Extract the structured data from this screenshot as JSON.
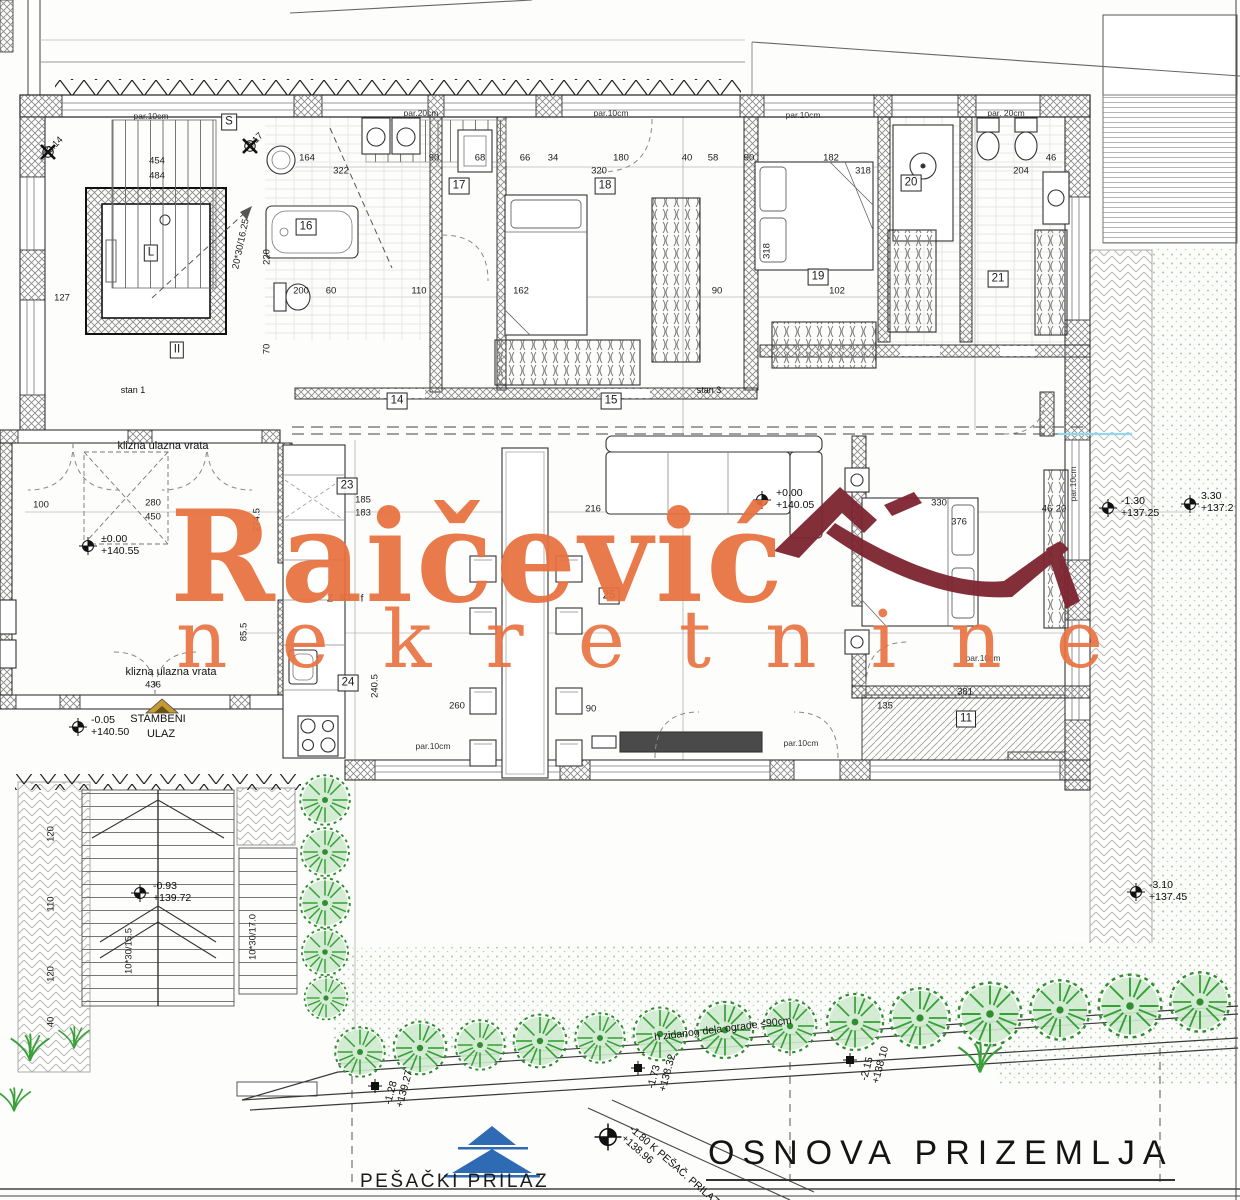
{
  "watermark": {
    "name": "Raičević",
    "subtitle": "nekretnine",
    "accent_color": "#e8713f",
    "roof_color": "#7d2430"
  },
  "title_block": {
    "title": "OSNOVA PRIZEMLJA"
  },
  "site": {
    "pesacki_prilaz": "PEŠAČKI PRILAZ"
  },
  "colors": {
    "tree_green": "#35a035",
    "lawn_dot": "#a3cba3",
    "blue_symbol": "#2f6ab5",
    "gold_symbol": "#c49a33",
    "cyan_line": "#8fd8ea"
  },
  "room_labels": [
    {
      "label": "S",
      "x": 229,
      "y": 122
    },
    {
      "label": "L",
      "x": 151,
      "y": 253
    },
    {
      "label": "II",
      "x": 177,
      "y": 350
    },
    {
      "label": "16",
      "x": 306,
      "y": 227
    },
    {
      "label": "17",
      "x": 459,
      "y": 186
    },
    {
      "label": "18",
      "x": 605,
      "y": 186
    },
    {
      "label": "19",
      "x": 818,
      "y": 277
    },
    {
      "label": "20",
      "x": 911,
      "y": 183
    },
    {
      "label": "21",
      "x": 998,
      "y": 279
    },
    {
      "label": "14",
      "x": 397,
      "y": 401
    },
    {
      "label": "15",
      "x": 611,
      "y": 401
    },
    {
      "label": "23",
      "x": 347,
      "y": 486
    },
    {
      "label": "24",
      "x": 348,
      "y": 683
    },
    {
      "label": "25",
      "x": 609,
      "y": 596
    },
    {
      "label": "11",
      "x": 966,
      "y": 719
    }
  ],
  "dim_labels": [
    {
      "t": "454",
      "x": 157,
      "y": 161
    },
    {
      "t": "484",
      "x": 157,
      "y": 176
    },
    {
      "t": "127",
      "x": 62,
      "y": 298
    },
    {
      "t": "164",
      "x": 307,
      "y": 158
    },
    {
      "t": "90",
      "x": 434,
      "y": 158
    },
    {
      "t": "68",
      "x": 480,
      "y": 158
    },
    {
      "t": "66",
      "x": 525,
      "y": 158
    },
    {
      "t": "34",
      "x": 553,
      "y": 158
    },
    {
      "t": "180",
      "x": 621,
      "y": 158
    },
    {
      "t": "40",
      "x": 687,
      "y": 158
    },
    {
      "t": "58",
      "x": 713,
      "y": 158
    },
    {
      "t": "90",
      "x": 749,
      "y": 158
    },
    {
      "t": "182",
      "x": 831,
      "y": 158
    },
    {
      "t": "46",
      "x": 1051,
      "y": 158
    },
    {
      "t": "322",
      "x": 341,
      "y": 171
    },
    {
      "t": "320",
      "x": 599,
      "y": 171
    },
    {
      "t": "318",
      "x": 863,
      "y": 171
    },
    {
      "t": "204",
      "x": 1021,
      "y": 171
    },
    {
      "t": "200",
      "x": 301,
      "y": 291
    },
    {
      "t": "60",
      "x": 331,
      "y": 291
    },
    {
      "t": "110",
      "x": 419,
      "y": 291
    },
    {
      "t": "162",
      "x": 521,
      "y": 291
    },
    {
      "t": "90",
      "x": 717,
      "y": 291
    },
    {
      "t": "102",
      "x": 837,
      "y": 291
    },
    {
      "t": "100",
      "x": 41,
      "y": 505
    },
    {
      "t": "280",
      "x": 153,
      "y": 503
    },
    {
      "t": "450",
      "x": 153,
      "y": 517
    },
    {
      "t": "185",
      "x": 363,
      "y": 500
    },
    {
      "t": "183",
      "x": 363,
      "y": 513
    },
    {
      "t": "216",
      "x": 593,
      "y": 509
    },
    {
      "t": "330",
      "x": 939,
      "y": 503
    },
    {
      "t": "376",
      "x": 959,
      "y": 522
    },
    {
      "t": "46",
      "x": 1047,
      "y": 509
    },
    {
      "t": "20",
      "x": 1061,
      "y": 509
    },
    {
      "t": "63",
      "x": 345,
      "y": 598
    },
    {
      "t": "436",
      "x": 153,
      "y": 685
    },
    {
      "t": "260",
      "x": 457,
      "y": 706
    },
    {
      "t": "90",
      "x": 591,
      "y": 709
    },
    {
      "t": "381",
      "x": 965,
      "y": 692
    },
    {
      "t": "135",
      "x": 885,
      "y": 706
    },
    {
      "t": "220",
      "x": 267,
      "y": 257,
      "r": -90
    },
    {
      "t": "70",
      "x": 267,
      "y": 349,
      "r": -90
    },
    {
      "t": "274.5",
      "x": 257,
      "y": 520,
      "r": -90
    },
    {
      "t": "85.5",
      "x": 244,
      "y": 632,
      "r": -90
    },
    {
      "t": "240.5",
      "x": 375,
      "y": 686,
      "r": -90
    },
    {
      "t": "318",
      "x": 767,
      "y": 251,
      "r": -90
    },
    {
      "t": "120",
      "x": 51,
      "y": 834,
      "r": -90
    },
    {
      "t": "110",
      "x": 51,
      "y": 904,
      "r": -90
    },
    {
      "t": "120",
      "x": 51,
      "y": 974,
      "r": -90
    },
    {
      "t": "40",
      "x": 51,
      "y": 1022,
      "r": -90
    },
    {
      "t": "10*30/15.5",
      "x": 129,
      "y": 951,
      "r": -90
    },
    {
      "t": "10*30/17.0",
      "x": 253,
      "y": 937,
      "r": -90
    },
    {
      "t": "20*30/16.25",
      "x": 241,
      "y": 244,
      "r": -78
    },
    {
      "t": "-2.14",
      "x": 54,
      "y": 146,
      "r": -45
    },
    {
      "t": "-2.17",
      "x": 254,
      "y": 142,
      "r": -45
    }
  ],
  "wall_notes": [
    {
      "t": "par.10cm",
      "x": 151,
      "y": 116
    },
    {
      "t": "par.20cm",
      "x": 421,
      "y": 113
    },
    {
      "t": "par.10cm",
      "x": 611,
      "y": 113
    },
    {
      "t": "par.10cm",
      "x": 803,
      "y": 115
    },
    {
      "t": "par. 20cm",
      "x": 1006,
      "y": 113
    },
    {
      "t": "par.10cm",
      "x": 433,
      "y": 746
    },
    {
      "t": "par.10cm",
      "x": 801,
      "y": 743
    },
    {
      "t": "par.10cm",
      "x": 1073,
      "y": 484,
      "r": -90
    },
    {
      "t": "par.10cm",
      "x": 983,
      "y": 658
    }
  ],
  "notes": [
    {
      "t": "klizna ulazna vrata",
      "x": 163,
      "y": 446,
      "s": 11
    },
    {
      "t": "klizna ulazna vrata",
      "x": 171,
      "y": 672,
      "s": 11
    },
    {
      "t": "STAMBENI",
      "x": 158,
      "y": 719,
      "s": 11
    },
    {
      "t": "ULAZ",
      "x": 161,
      "y": 734,
      "s": 11
    },
    {
      "t": "stan 1",
      "x": 133,
      "y": 390,
      "s": 9
    },
    {
      "t": "stan 3",
      "x": 709,
      "y": 390,
      "s": 9
    },
    {
      "t": "Z",
      "x": 330,
      "y": 599,
      "s": 10
    },
    {
      "t": "f",
      "x": 362,
      "y": 599,
      "s": 10
    },
    {
      "t": "h zidanog dela ograde ≤90cm",
      "x": 723,
      "y": 1029,
      "s": 10.5,
      "r": -7
    }
  ],
  "level_markers": [
    {
      "l1": "±0.00",
      "l2": "+140.55",
      "x": 101,
      "y": 534
    },
    {
      "l1": "-0.05",
      "l2": "+140.50",
      "x": 91,
      "y": 715
    },
    {
      "l1": "+0.00",
      "l2": "+140.05",
      "x": 776,
      "y": 488
    },
    {
      "l1": "-1.30",
      "l2": "+137.25",
      "x": 1121,
      "y": 496
    },
    {
      "l1": "3.30",
      "l2": "+137.2",
      "x": 1201,
      "y": 491
    },
    {
      "l1": "-3.10",
      "l2": "+137.45",
      "x": 1149,
      "y": 880
    },
    {
      "l1": "-0.93",
      "l2": "+139.72",
      "x": 153,
      "y": 881
    },
    {
      "l1": "-1.28",
      "l2": "+139.27",
      "x": 383,
      "y": 1103,
      "r": -75
    },
    {
      "l1": "-1.73",
      "l2": "+138.32",
      "x": 646,
      "y": 1087,
      "r": -75
    },
    {
      "l1": "-2.15",
      "l2": "+138.10",
      "x": 859,
      "y": 1079,
      "r": -75
    },
    {
      "l1": "-1.80 K PEŠAČ. PRILAZ",
      "l2": "+138.96",
      "x": 634,
      "y": 1124,
      "r": 41
    }
  ]
}
